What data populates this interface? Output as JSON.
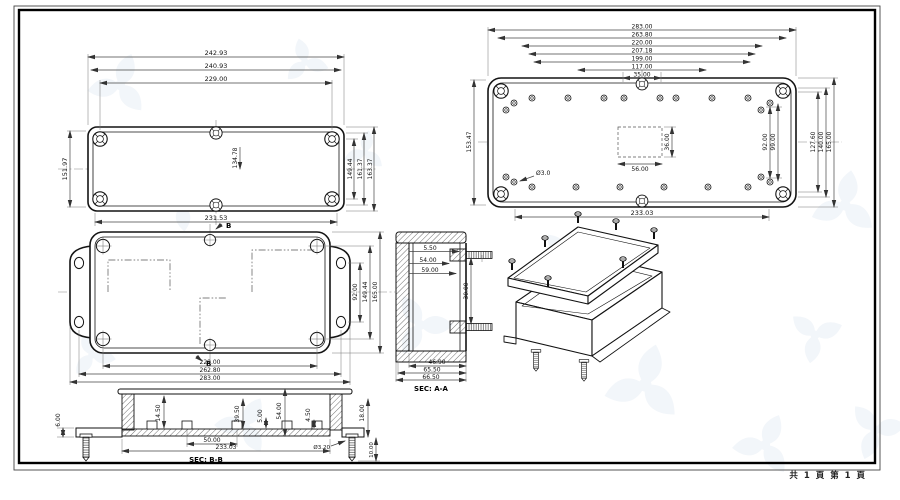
{
  "page": {
    "footer": "共 1 頁  第 1 頁"
  },
  "views": {
    "lid_top": {
      "dims_top": [
        "242.93",
        "240.93",
        "229.00"
      ],
      "dim_left": "151.97",
      "dims_right": [
        "149.44",
        "161.37",
        "163.37"
      ],
      "dim_center": "134.78",
      "dim_bottom": "231.53"
    },
    "base_top": {
      "dims_top": [
        "283.00",
        "263.80",
        "220.00",
        "207.18",
        "199.00",
        "117.00",
        "35.00"
      ],
      "dim_left": "153.47",
      "dims_right": [
        "92.00",
        "99.00",
        "127.60",
        "140.00",
        "165.00"
      ],
      "inner_width": "56.00",
      "inner_height": "36.00",
      "hole_label": "Ø3.0",
      "dim_bottom": "233.03"
    },
    "bottom_view": {
      "dims_bottom": [
        "229.00",
        "262.80",
        "283.00"
      ],
      "dims_right": [
        "92.00",
        "149.44",
        "165.00"
      ],
      "section_marker": "B"
    },
    "section_aa": {
      "label": "SEC: A-A",
      "leaders": [
        "5.50",
        "54.00",
        "59.00"
      ],
      "dim_screw_span": "30.00",
      "dims_bottom": [
        "46.90",
        "65.50",
        "66.50"
      ]
    },
    "section_bb": {
      "label": "SEC: B-B",
      "dim_left": "6.00",
      "dims_inner": [
        "14.50",
        "39.50",
        "5.00",
        "54.00",
        "4.50"
      ],
      "dim_right": "18.00",
      "dims_bottom": [
        "50.00",
        "233.03"
      ],
      "screw_dia": "Ø3.20",
      "screw_len": "10.00"
    }
  }
}
